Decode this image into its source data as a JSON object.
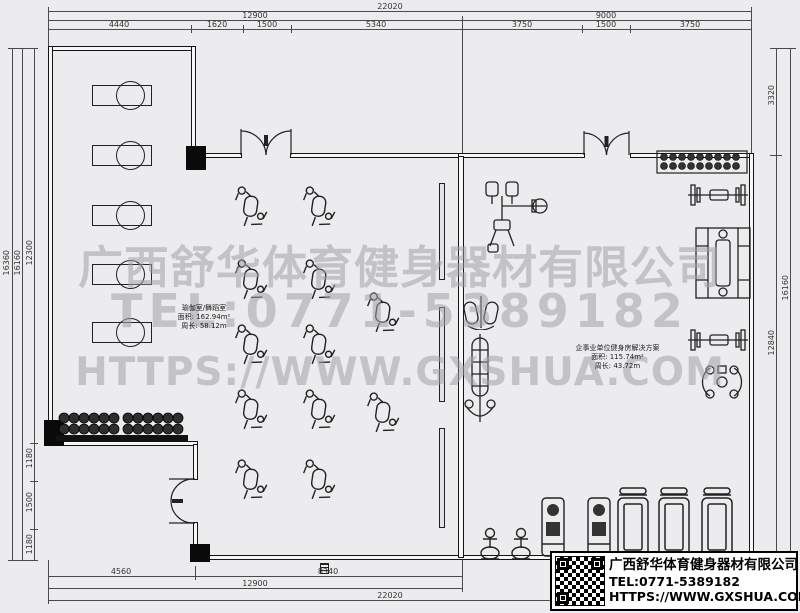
{
  "watermark": {
    "line1": "广西舒华体育健身器材有限公司",
    "line2": "TEL:0771-5389182",
    "line3": "HTTPS://WWW.GXSHUA.COM"
  },
  "info_box": {
    "company": "广西舒华体育健身器材有限公司",
    "tel": "TEL:0771-5389182",
    "website": "HTTPS://WWW.GXSHUA.COM"
  },
  "rooms": [
    {
      "name": "瑜伽室/舞蹈室",
      "area": "面积: 162.94m²",
      "perimeter": "周长: 58.12m"
    },
    {
      "name": "企事业单位健身房解决方案",
      "area": "面积: 115.74m²",
      "perimeter": "周长: 43.72m"
    }
  ],
  "dimensions": {
    "top_total": "22020",
    "top_row2": [
      "12900",
      "9000"
    ],
    "top_row3": [
      "4440",
      "1620",
      "1500",
      "5340",
      "3750",
      "1500",
      "3750"
    ],
    "bottom_row1": [
      "4560",
      "8340"
    ],
    "bottom_row2": "12900",
    "bottom_row3": "22020",
    "left": {
      "outer": "16360",
      "inner": "16160",
      "upper": "12300",
      "segments": [
        "1180",
        "1500",
        "1180"
      ]
    },
    "right": {
      "top": "3320",
      "lower": "12840",
      "outer": "16160"
    }
  },
  "colors": {
    "background": "#ececee",
    "wall": "#141414",
    "watermark": "#a2a3a8"
  },
  "icons": {
    "spin_bike": "spin-bike-icon",
    "upright_bike": "upright-bike-icon",
    "treadmill": "treadmill-icon",
    "seated_machine": "seated-machine-icon",
    "massage_table": "massage-table-icon",
    "dumbbell_rack": "dumbbell-rack-icon",
    "barbell_bench": "barbell-bench-icon",
    "cable_station": "cable-station-icon",
    "smith_machine": "smith-machine-icon",
    "pec_fly": "pec-fly-icon",
    "stepper": "stepper-icon",
    "climber": "climber-icon",
    "mirror": "mirror-strip",
    "double_door": "double-swing-door-icon",
    "floor_drain": "floor-drain-icon",
    "qr": "qr-code"
  }
}
